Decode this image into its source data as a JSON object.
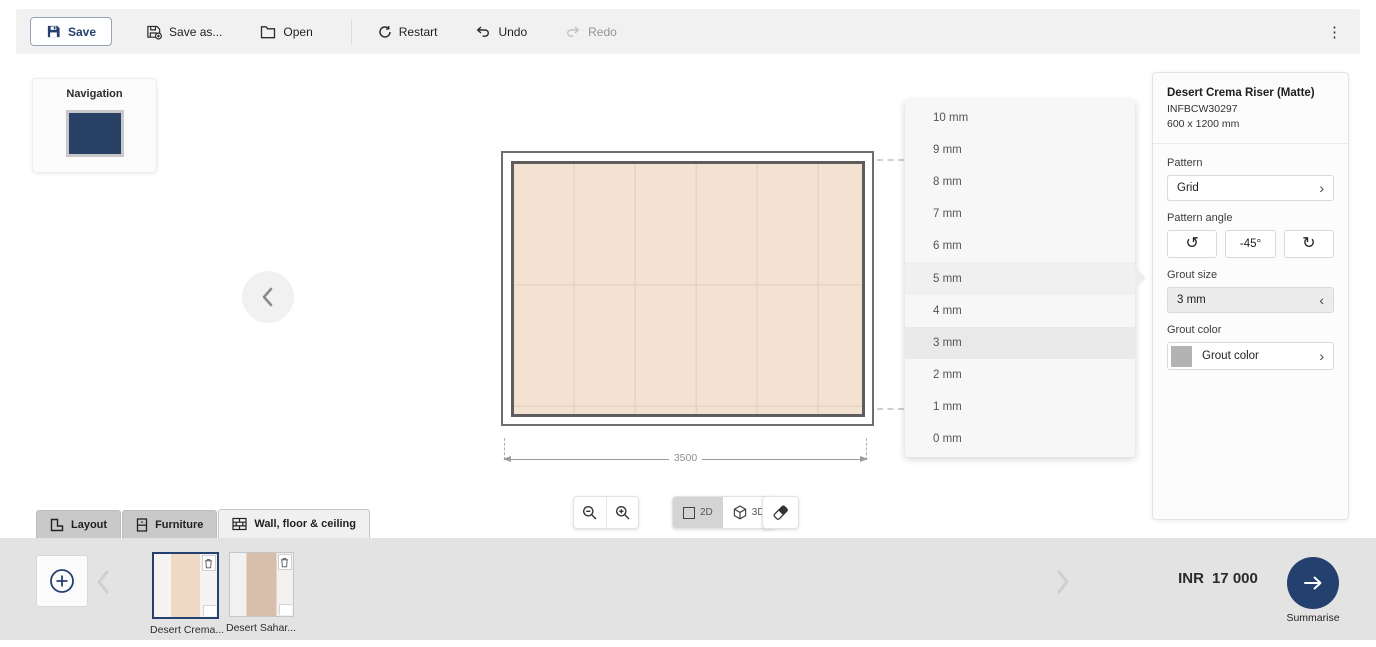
{
  "toolbar": {
    "save": "Save",
    "save_as": "Save as...",
    "open": "Open",
    "restart": "Restart",
    "undo": "Undo",
    "redo": "Redo"
  },
  "navigation": {
    "title": "Navigation"
  },
  "canvas": {
    "wall_width_label": "3500",
    "tile_color": "#f3e2d2",
    "grout_line_color": "#e6d4c4"
  },
  "grout_dropdown": {
    "items": [
      "10 mm",
      "9 mm",
      "8 mm",
      "7 mm",
      "6 mm",
      "5 mm",
      "4 mm",
      "3 mm",
      "2 mm",
      "1 mm",
      "0 mm"
    ],
    "selected": "3 mm",
    "hovered": "5 mm"
  },
  "properties": {
    "product_name": "Desert Crema Riser (Matte)",
    "product_code": "INFBCW30297",
    "product_size": "600 x 1200 mm",
    "pattern_label": "Pattern",
    "pattern_value": "Grid",
    "pattern_angle_label": "Pattern angle",
    "pattern_angle_value": "-45°",
    "grout_size_label": "Grout size",
    "grout_size_value": "3 mm",
    "grout_color_label": "Grout color",
    "grout_color_value": "Grout color",
    "grout_color_hex": "#b3b3b3"
  },
  "view_controls": {
    "mode_2d": "2D",
    "mode_3d": "3D"
  },
  "tabs": [
    {
      "label": "Layout"
    },
    {
      "label": "Furniture"
    },
    {
      "label": "Wall, floor & ceiling"
    }
  ],
  "bottom_bar": {
    "products": [
      {
        "name": "Desert Crema...",
        "selected": true
      },
      {
        "name": "Desert Sahar...",
        "selected": false
      }
    ],
    "price_currency": "INR",
    "price_value": "17 000",
    "summarise_label": "Summarise"
  },
  "icons": {
    "kebab": "⋮",
    "chevron_right": "›",
    "chevron_left": "‹",
    "rotate_ccw": "↺",
    "rotate_cw": "↻"
  },
  "colors": {
    "accent_navy": "#24406e",
    "toolbar_bg": "#f1f1f2",
    "bottom_bar_bg": "#e3e3e4",
    "thumb1_stripe": "#eed9c5",
    "thumb2_stripe": "#d8bfac"
  }
}
